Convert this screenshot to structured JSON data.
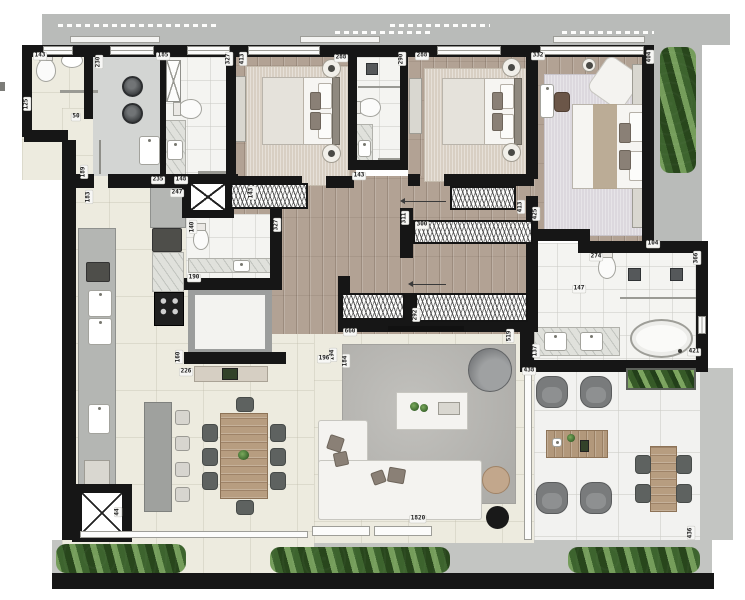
{
  "colors": {
    "wall": "#161616",
    "wood_floor": "#b2a294",
    "cream_floor": "#edebdf",
    "bath_floor": "#f4f4f1",
    "terrace_floor": "#f2f2f0",
    "walkway": "#c3c5c2",
    "top_band": "#b9bbb9",
    "laundry_floor": "#d3d5d3",
    "bedroom_rug": "#d8cfc3",
    "master_rug": "#dcd8de",
    "living_rug": "#b3b2ae",
    "sofa": "#f4f3f0",
    "dark_chair": "#5e6260",
    "wood_table": "#b79d80",
    "hedge_green": "#47682f"
  },
  "dimension_labels": [
    {
      "text": "143",
      "x": 40,
      "y": 56
    },
    {
      "text": "125",
      "x": 27,
      "y": 104,
      "v": true
    },
    {
      "text": "50",
      "x": 76,
      "y": 117
    },
    {
      "text": "230",
      "x": 99,
      "y": 62,
      "v": true
    },
    {
      "text": "189",
      "x": 84,
      "y": 172,
      "v": true
    },
    {
      "text": "183",
      "x": 89,
      "y": 197,
      "v": true
    },
    {
      "text": "185",
      "x": 163,
      "y": 56
    },
    {
      "text": "235",
      "x": 158,
      "y": 180
    },
    {
      "text": "148",
      "x": 181,
      "y": 180
    },
    {
      "text": "327",
      "x": 229,
      "y": 59,
      "v": true
    },
    {
      "text": "413",
      "x": 243,
      "y": 59,
      "v": true
    },
    {
      "text": "143",
      "x": 252,
      "y": 193,
      "v": true
    },
    {
      "text": "288",
      "x": 341,
      "y": 58
    },
    {
      "text": "290",
      "x": 402,
      "y": 59,
      "v": true
    },
    {
      "text": "288",
      "x": 422,
      "y": 56
    },
    {
      "text": "332",
      "x": 538,
      "y": 56
    },
    {
      "text": "404",
      "x": 650,
      "y": 57,
      "v": true
    },
    {
      "text": "143",
      "x": 359,
      "y": 176
    },
    {
      "text": "311",
      "x": 405,
      "y": 218,
      "v": true
    },
    {
      "text": "300",
      "x": 422,
      "y": 225
    },
    {
      "text": "413",
      "x": 521,
      "y": 207,
      "v": true
    },
    {
      "text": "425",
      "x": 536,
      "y": 214,
      "v": true
    },
    {
      "text": "327",
      "x": 277,
      "y": 225,
      "v": true
    },
    {
      "text": "140",
      "x": 193,
      "y": 227,
      "v": true
    },
    {
      "text": "247",
      "x": 177,
      "y": 193
    },
    {
      "text": "190",
      "x": 194,
      "y": 278
    },
    {
      "text": "292",
      "x": 416,
      "y": 315,
      "v": true
    },
    {
      "text": "660",
      "x": 350,
      "y": 332
    },
    {
      "text": "519",
      "x": 510,
      "y": 336,
      "v": true
    },
    {
      "text": "137",
      "x": 536,
      "y": 351,
      "v": true
    },
    {
      "text": "194",
      "x": 333,
      "y": 355,
      "v": true
    },
    {
      "text": "184",
      "x": 346,
      "y": 361,
      "v": true
    },
    {
      "text": "196",
      "x": 324,
      "y": 359
    },
    {
      "text": "160",
      "x": 179,
      "y": 357,
      "v": true
    },
    {
      "text": "226",
      "x": 186,
      "y": 372
    },
    {
      "text": "104",
      "x": 653,
      "y": 244
    },
    {
      "text": "274",
      "x": 596,
      "y": 257
    },
    {
      "text": "366",
      "x": 697,
      "y": 258,
      "v": true
    },
    {
      "text": "147",
      "x": 579,
      "y": 289
    },
    {
      "text": "421",
      "x": 694,
      "y": 352
    },
    {
      "text": "438",
      "x": 529,
      "y": 371
    },
    {
      "text": "436",
      "x": 691,
      "y": 533,
      "v": true
    },
    {
      "text": "1820",
      "x": 418,
      "y": 519
    },
    {
      "text": "44",
      "x": 118,
      "y": 512,
      "v": true
    }
  ]
}
